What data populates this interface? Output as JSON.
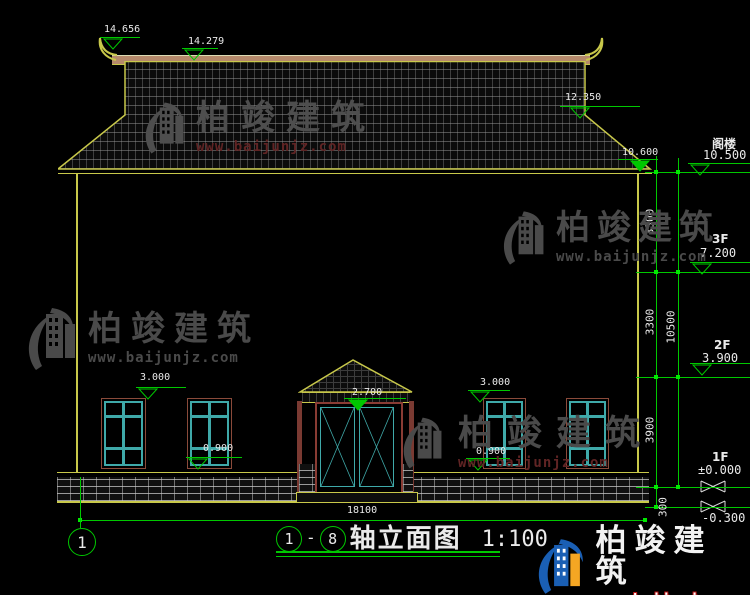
{
  "watermark": {
    "brand": "柏竣建筑",
    "url": "www.baijunjz.com"
  },
  "markers": {
    "r14656": "14.656",
    "r14279": "14.279",
    "r12350": "12.350",
    "r10600": "10.600",
    "win3000_left": "3.000",
    "win0900_left": "0.900",
    "door2700": "2.700",
    "win3000_right": "3.000",
    "win0900_right": "0.900"
  },
  "floors": {
    "attic": {
      "label": "阁楼",
      "value": "10.500"
    },
    "f3": {
      "label": "3F",
      "value": "7.200"
    },
    "f2": {
      "label": "2F",
      "value": "3.900"
    },
    "f1": {
      "label": "1F",
      "value": "±0.000"
    },
    "base": {
      "value": "-0.300"
    }
  },
  "dims": {
    "floor_attic": "3300",
    "floor_3": "3300",
    "floor_1": "3900",
    "plinth": "300",
    "total_height": "10500",
    "total_width": "18100"
  },
  "titlebar": {
    "axis_start": "1",
    "separator": "-",
    "axis_end": "8",
    "name": "轴立面图",
    "scale": "1:100"
  },
  "axis_bubble": {
    "left": "1"
  }
}
